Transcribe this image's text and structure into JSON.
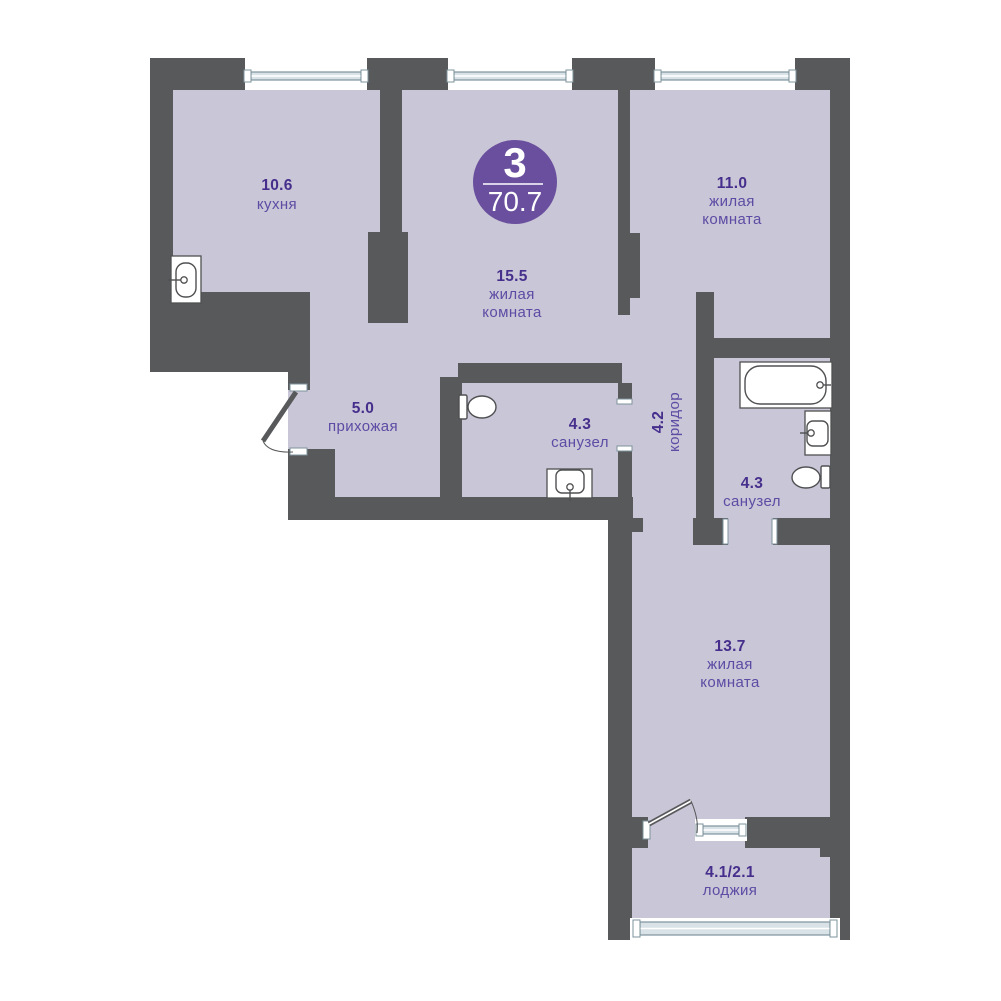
{
  "palette": {
    "background": "#ffffff",
    "wall": "#58595b",
    "floor": "#c9c6d7",
    "badge_fill": "#6a4f9e",
    "badge_text": "#ffffff",
    "area_text": "#462f8c",
    "name_text": "#5d4ba4",
    "glazing_fill": "#d9e2e7",
    "glazing_stroke": "#7e939e",
    "fixture_stroke": "#4f5052",
    "fixture_fill": "#ffffff"
  },
  "badge": {
    "cx": 515,
    "cy": 182,
    "r": 42,
    "rooms_count": "3",
    "total_area": "70.7",
    "line": [
      483,
      184,
      543,
      184
    ]
  },
  "outline": "150,58 850,58 850,940 608,940 608,520 288,520 288,372 150,372",
  "walls": [
    [
      150,
      58,
      95,
      32
    ],
    [
      367,
      58,
      81,
      32
    ],
    [
      572,
      58,
      83,
      32
    ],
    [
      795,
      58,
      55,
      32
    ],
    [
      150,
      90,
      23,
      202
    ],
    [
      150,
      292,
      160,
      80
    ],
    [
      288,
      372,
      22,
      18
    ],
    [
      288,
      449,
      47,
      71
    ],
    [
      288,
      497,
      345,
      23
    ],
    [
      380,
      90,
      22,
      142
    ],
    [
      368,
      232,
      40,
      91
    ],
    [
      440,
      377,
      22,
      120
    ],
    [
      458,
      363,
      164,
      20
    ],
    [
      618,
      383,
      14,
      20
    ],
    [
      618,
      448,
      14,
      49
    ],
    [
      618,
      88,
      12,
      227
    ],
    [
      630,
      233,
      10,
      65
    ],
    [
      696,
      292,
      18,
      253
    ],
    [
      713,
      338,
      137,
      20
    ],
    [
      830,
      58,
      20,
      882
    ],
    [
      693,
      518,
      35,
      27
    ],
    [
      773,
      518,
      57,
      27
    ],
    [
      632,
      518,
      11,
      14
    ],
    [
      608,
      513,
      24,
      427
    ],
    [
      608,
      817,
      40,
      31
    ],
    [
      745,
      817,
      85,
      31
    ],
    [
      820,
      843,
      10,
      14
    ]
  ],
  "windows": [
    {
      "x": 245,
      "y": 58,
      "w": 122,
      "h": 32,
      "kind": "top"
    },
    {
      "x": 448,
      "y": 58,
      "w": 124,
      "h": 32,
      "kind": "top"
    },
    {
      "x": 655,
      "y": 58,
      "w": 140,
      "h": 32,
      "kind": "top"
    },
    {
      "x": 695,
      "y": 819,
      "w": 52,
      "h": 22,
      "kind": "small"
    },
    {
      "x": 630,
      "y": 918,
      "w": 210,
      "h": 22,
      "kind": "wide"
    }
  ],
  "jamb_caps": [
    [
      290,
      384,
      17,
      7
    ],
    [
      290,
      448,
      17,
      7
    ],
    [
      617,
      399,
      15,
      5
    ],
    [
      617,
      446,
      15,
      5
    ],
    [
      723,
      519,
      5,
      25
    ],
    [
      772,
      519,
      5,
      25
    ],
    [
      643,
      821,
      7,
      18
    ]
  ],
  "doors": [
    {
      "id": "entrance-door",
      "leaf": [
        296,
        392,
        263,
        441
      ],
      "arc": "M263,441 Q268,453 293,452",
      "solid": true
    },
    {
      "id": "loggia-door",
      "leaf": [
        649,
        824,
        691,
        801
      ],
      "arc": "M691,801 Q699,819 697,833",
      "solid": false
    }
  ],
  "fixtures": [
    {
      "id": "kitchen-sink",
      "type": "sink",
      "box": [
        171,
        256,
        30,
        47
      ],
      "basin": [
        176,
        263,
        20,
        34
      ],
      "basin_rx": 9,
      "tap_line": [
        168,
        280,
        181,
        280
      ],
      "tap_c": [
        184,
        280
      ]
    },
    {
      "id": "toilet-1",
      "type": "toilet",
      "tank": [
        459,
        395,
        8,
        24
      ],
      "bowl": [
        468,
        396,
        28,
        22
      ]
    },
    {
      "id": "washbasin-1",
      "type": "basin",
      "box": [
        547,
        469,
        45,
        29
      ],
      "basin": [
        556,
        470,
        28,
        23
      ],
      "basin_rx": 6,
      "tap_line": [
        570,
        490,
        570,
        501
      ],
      "tap_c": [
        570,
        487
      ]
    },
    {
      "id": "bathtub",
      "type": "bath",
      "box": [
        740,
        362,
        92,
        46
      ],
      "basin": [
        745,
        366,
        81,
        38
      ],
      "basin_rx": 15,
      "tap_line": [
        822,
        385,
        831,
        385
      ],
      "tap_c": [
        820,
        385
      ]
    },
    {
      "id": "washbasin-2",
      "type": "basin",
      "box": [
        805,
        411,
        26,
        44
      ],
      "basin": [
        807,
        421,
        21,
        25
      ],
      "basin_rx": 6,
      "tap_line": [
        800,
        433,
        808,
        433
      ],
      "tap_c": [
        811,
        433
      ]
    },
    {
      "id": "toilet-2",
      "type": "toilet",
      "tank": [
        821,
        466,
        9,
        22
      ],
      "bowl": [
        792,
        467,
        28,
        21
      ]
    }
  ],
  "rooms": [
    {
      "id": "kitchen",
      "area": "10.6",
      "area_xy": [
        277,
        190
      ],
      "names": [
        {
          "t": "кухня",
          "xy": [
            277,
            209
          ]
        }
      ]
    },
    {
      "id": "living-room-main",
      "area": "15.5",
      "area_xy": [
        512,
        281
      ],
      "names": [
        {
          "t": "жилая",
          "xy": [
            512,
            299
          ]
        },
        {
          "t": "комната",
          "xy": [
            512,
            317
          ]
        }
      ]
    },
    {
      "id": "living-room-2",
      "area": "11.0",
      "area_xy": [
        732,
        188
      ],
      "names": [
        {
          "t": "жилая",
          "xy": [
            732,
            206
          ]
        },
        {
          "t": "комната",
          "xy": [
            732,
            224
          ]
        }
      ]
    },
    {
      "id": "hallway",
      "area": "5.0",
      "area_xy": [
        363,
        413
      ],
      "names": [
        {
          "t": "прихожая",
          "xy": [
            363,
            431
          ]
        }
      ]
    },
    {
      "id": "bathroom-1",
      "area": "4.3",
      "area_xy": [
        580,
        429
      ],
      "names": [
        {
          "t": "санузел",
          "xy": [
            580,
            447
          ]
        }
      ]
    },
    {
      "id": "corridor",
      "area": "4.2",
      "area_xy": [
        663,
        422
      ],
      "names": [
        {
          "t": "коридор",
          "xy": [
            679,
            422
          ]
        }
      ],
      "rotate": true
    },
    {
      "id": "bathroom-2",
      "area": "4.3",
      "area_xy": [
        752,
        488
      ],
      "names": [
        {
          "t": "санузел",
          "xy": [
            752,
            506
          ]
        }
      ]
    },
    {
      "id": "living-room-3",
      "area": "13.7",
      "area_xy": [
        730,
        651
      ],
      "names": [
        {
          "t": "жилая",
          "xy": [
            730,
            669
          ]
        },
        {
          "t": "комната",
          "xy": [
            730,
            687
          ]
        }
      ]
    },
    {
      "id": "loggia",
      "area": "4.1/2.1",
      "area_xy": [
        730,
        877
      ],
      "names": [
        {
          "t": "лоджия",
          "xy": [
            730,
            895
          ]
        }
      ]
    }
  ]
}
